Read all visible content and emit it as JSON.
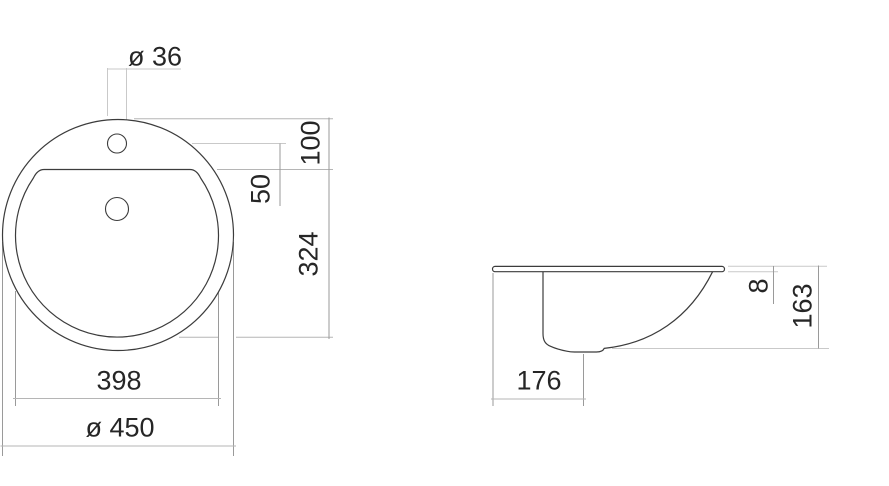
{
  "front_view": {
    "view_name": "top-view",
    "dims": {
      "faucet_hole_diameter": "ø 36",
      "rim_top_to_basin_edge": "100",
      "faucet_center_to_basin_edge": "50",
      "basin_edge_to_basin_bottom": "324",
      "basin_diameter": "398",
      "overall_diameter": "ø 450"
    }
  },
  "side_view": {
    "view_name": "section-view",
    "dims": {
      "rim_thickness": "8",
      "overall_depth": "163",
      "rim_edge_to_drain_center": "176"
    }
  },
  "colors": {
    "background": "#ffffff",
    "outline": "#3c3c3c",
    "dimension_line": "#9a9a9a",
    "extension_line_light": "#c9c9c9",
    "text": "#262626"
  }
}
